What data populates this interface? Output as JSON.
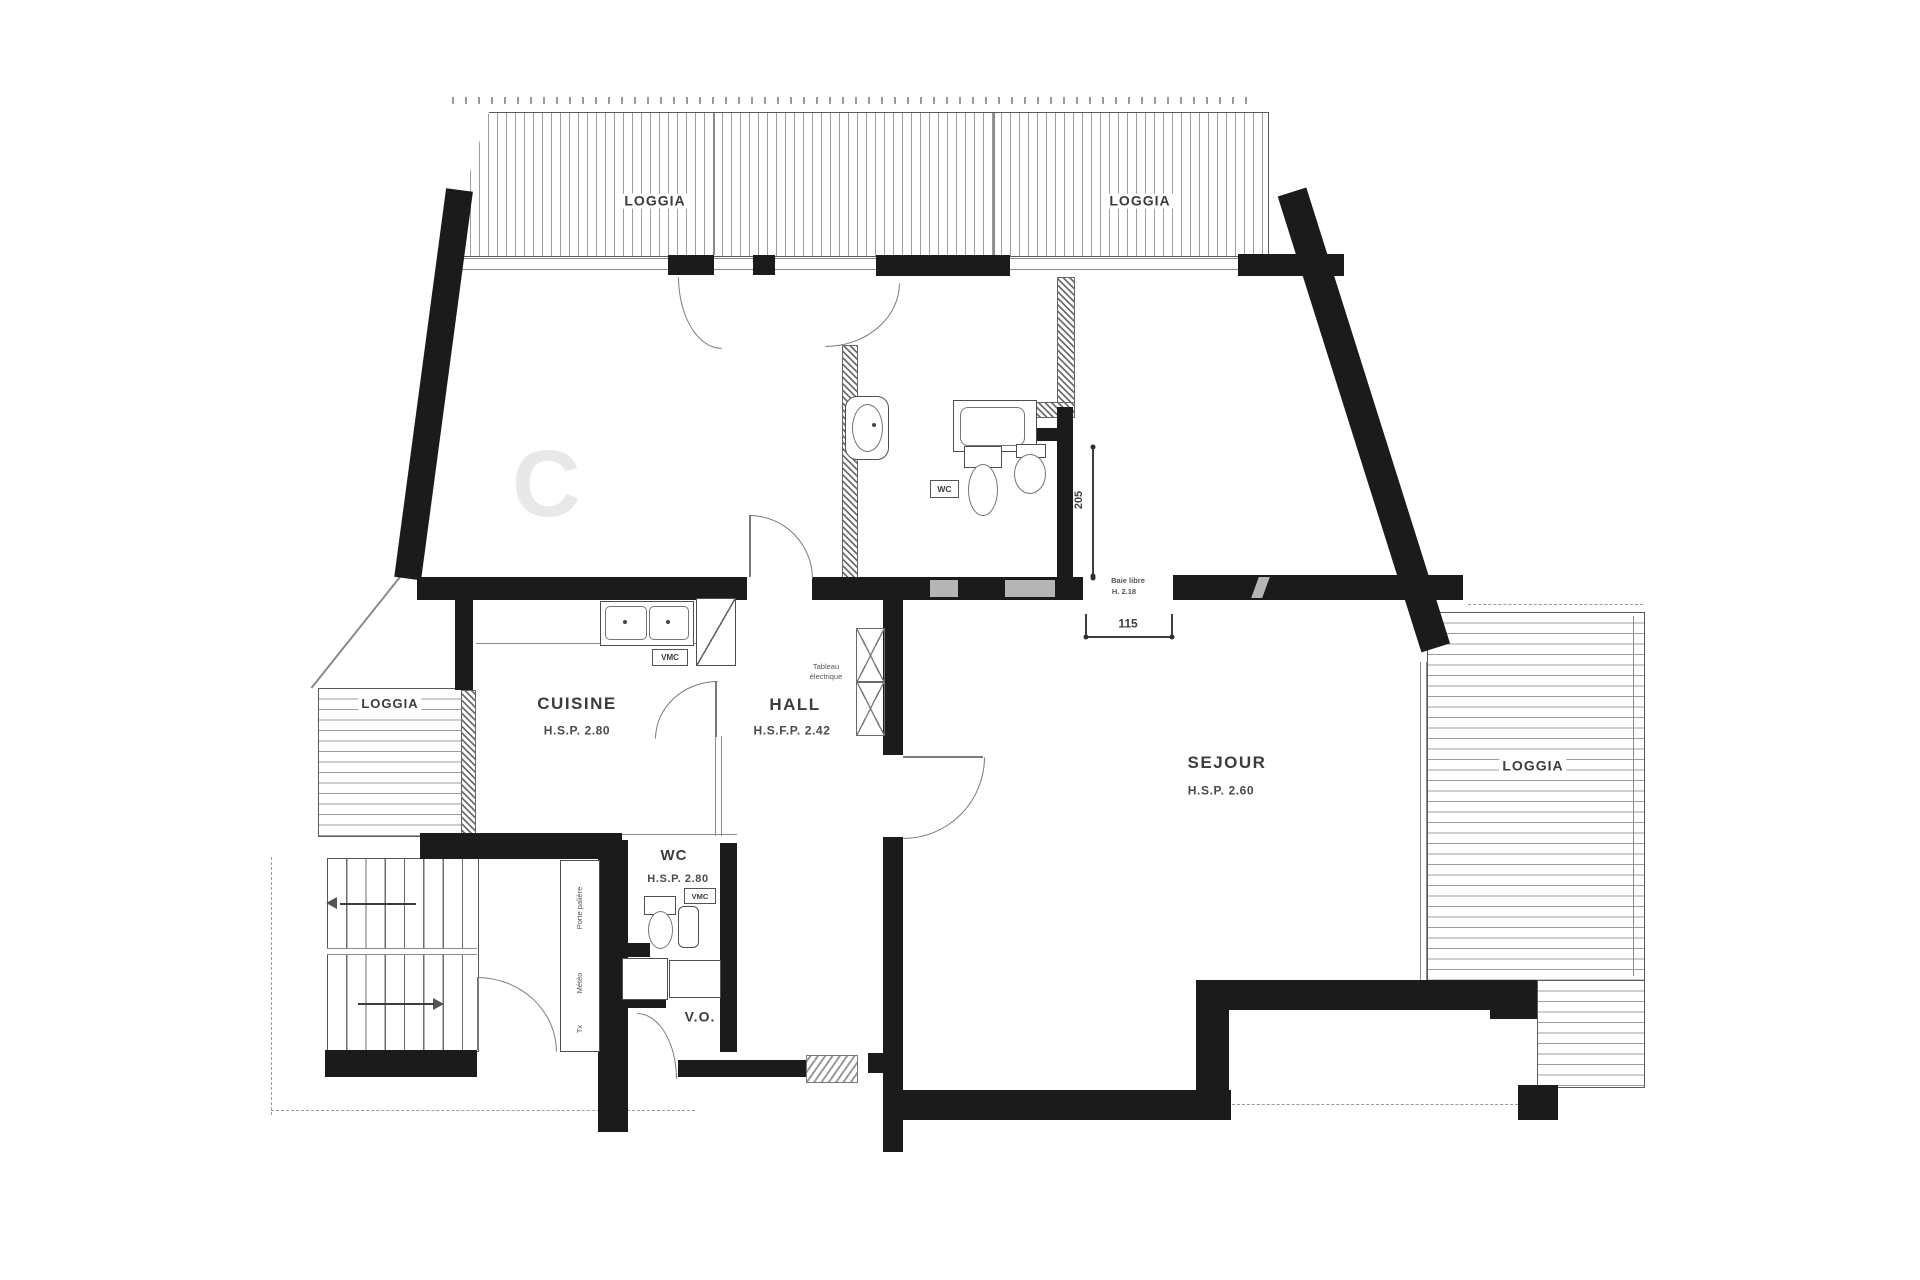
{
  "rooms": {
    "loggia_top_left": {
      "label": "LOGGIA"
    },
    "loggia_top_right": {
      "label": "LOGGIA"
    },
    "loggia_west": {
      "label": "LOGGIA"
    },
    "loggia_east": {
      "label": "LOGGIA"
    },
    "cuisine": {
      "label": "CUISINE",
      "ceiling": "H.S.P. 2.80"
    },
    "hall": {
      "label": "HALL",
      "ceiling": "H.S.F.P. 2.42"
    },
    "sejour": {
      "label": "SEJOUR",
      "ceiling": "H.S.P. 2.60"
    },
    "wc": {
      "label": "WC",
      "ceiling": "H.S.P. 2.80"
    },
    "vo": {
      "label": "V.O."
    }
  },
  "annotations": {
    "wc_fixture_tag": "WC",
    "vmc_kitchen": "VMC",
    "vmc_wc": "VMC",
    "tableau_line1": "Tableau",
    "tableau_line2": "électrique",
    "closet_top": "Porte palière",
    "closet_mid": "Météo",
    "closet_bottom": "Tx",
    "watermark": "C"
  },
  "dimensions": {
    "d205": "205",
    "d115": "115",
    "baie_label": "Baie libre",
    "baie_height": "H. 2.18"
  }
}
